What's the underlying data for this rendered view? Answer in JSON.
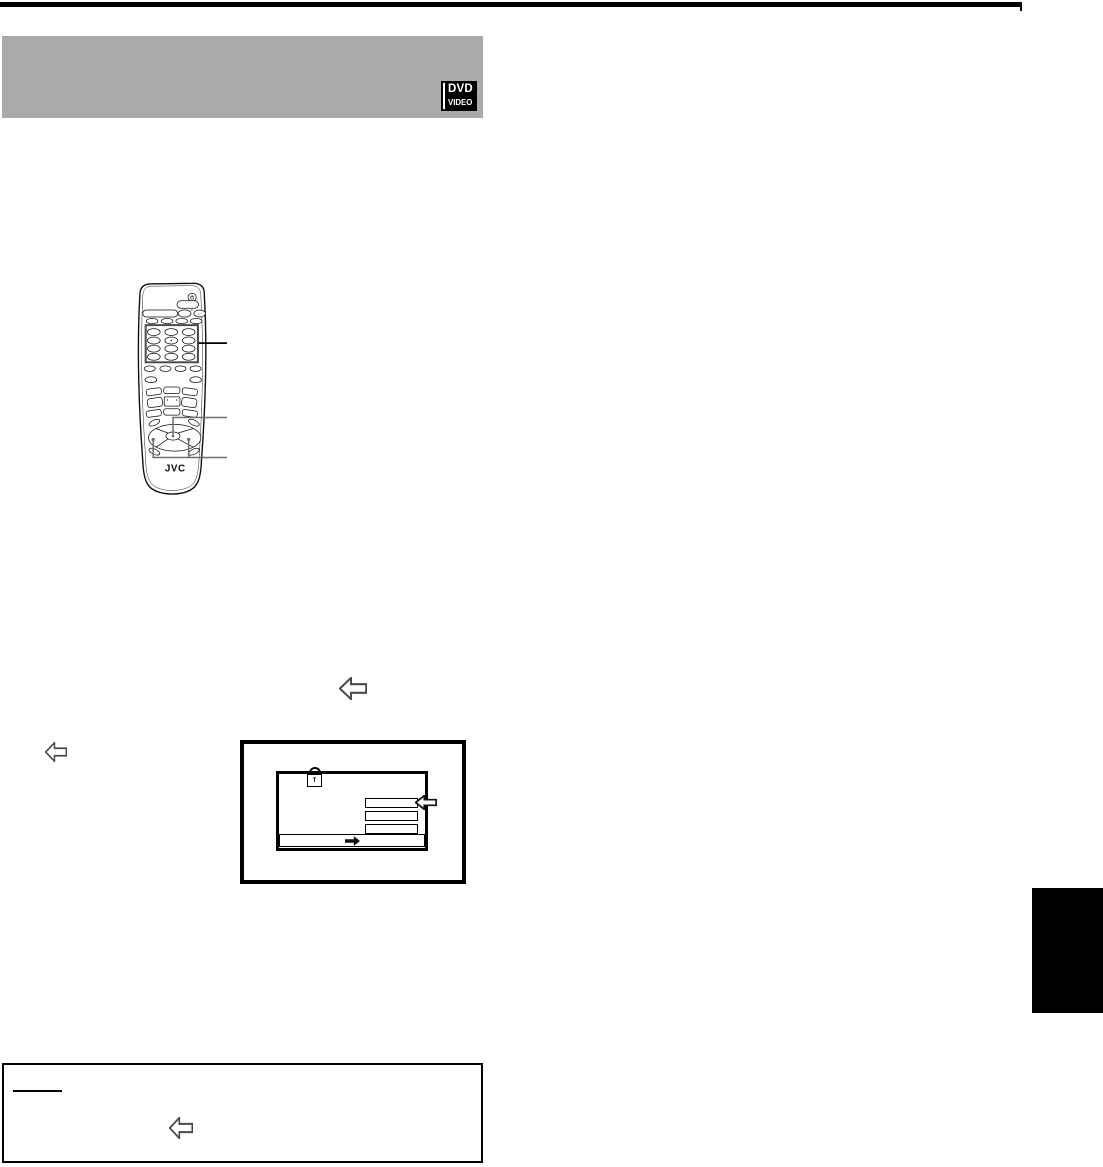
{
  "header": {
    "band_color": "#aaaaaa",
    "dvd_badge": {
      "line1": "DVD",
      "line2": "VIDEO"
    }
  },
  "remote": {
    "brand": "JVC",
    "dots": "···",
    "tiny_mark": "d1"
  },
  "tv_screen": {
    "lock_glyph": "T",
    "menu_rect_count": 3
  },
  "colors": {
    "rule": "#000000",
    "callout_primary": "#000000",
    "callout_secondary": "#6e6e6e",
    "keypad_outline": "#4a4a4a",
    "arrow_outline": "#4a4a4a"
  }
}
